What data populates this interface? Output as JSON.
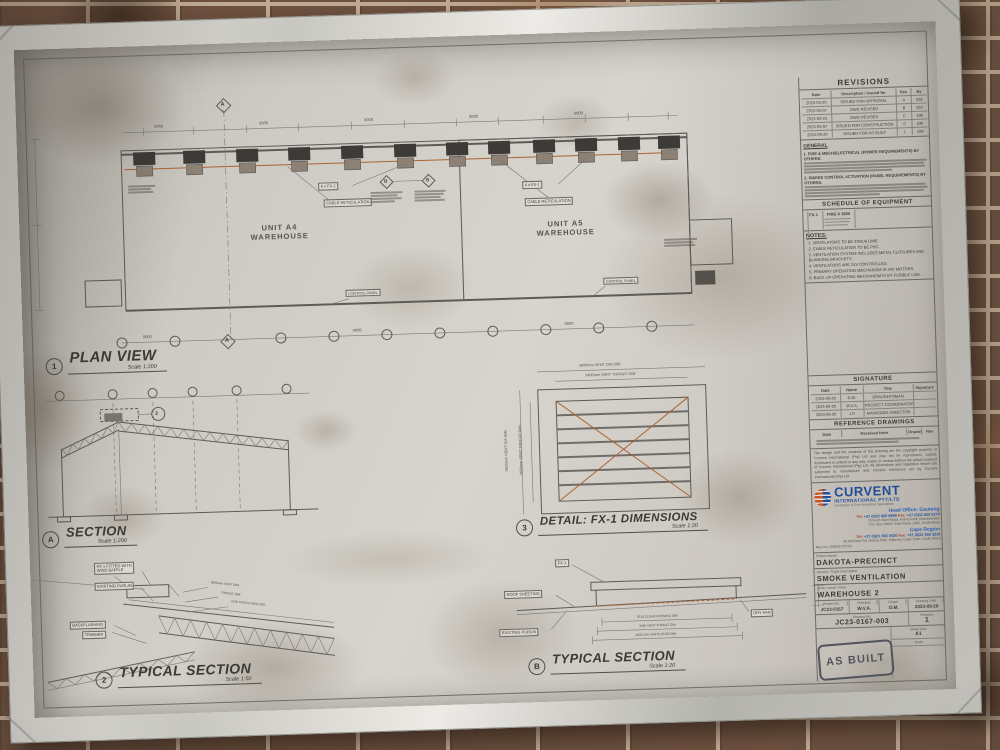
{
  "stamp": "AS BUILT",
  "plan": {
    "marker": "1",
    "title": "PLAN VIEW",
    "scale": "Scale 1:200",
    "unit_a4": "UNIT A4\nWAREHOUSE",
    "unit_a5": "UNIT A5\nWAREHOUSE",
    "fx_count_left": "6 x FX-1",
    "fx_count_right": "4 x FX-1",
    "cable_label": "CABLE RETICULATION",
    "control_label": "CONTROL PANEL",
    "bay_dim": "9000",
    "grid_a": "A",
    "grid_b": "B"
  },
  "section_a": {
    "marker": "A",
    "title": "SECTION",
    "scale": "Scale 1:200",
    "detail_ref": "2"
  },
  "detail_fx1": {
    "marker": "3",
    "title": "DETAIL: FX-1 DIMENSIONS",
    "scale": "Scale 1:20",
    "dim_oa_w": "3600mm VENT O/A DIM",
    "dim_throat_w": "3400mm VENT THROAT DIM",
    "dim_oa_h": "3600mm VENT O/A DIM",
    "dim_throat_h": "3400mm VENT THROAT DIM"
  },
  "typical_2": {
    "marker": "2",
    "title": "TYPICAL SECTION",
    "scale": "Scale 1:50",
    "label_baffle": "FX-1 FITTED WITH\nWIND BAFFLE",
    "label_purlin": "EXISTING PURLIN",
    "label_backflashing": "BACKFLASHING",
    "label_trimmer": "TRIMMER",
    "dim_1": "3600mm VENT DIM",
    "dim_2": "THROAT DIM",
    "dim_3": "END PURLIN SPACING"
  },
  "typical_b": {
    "marker": "B",
    "title": "TYPICAL SECTION",
    "scale": "Scale 1:20",
    "label_fx": "FX-1",
    "label_roof": "ROOF SHEETING",
    "label_purlin": "EXISTING PURLIN",
    "label_drypan": "DRY PAN",
    "dim_clear": "3518 CLEAR OPENING DIM",
    "dim_throat": "3400 VENT THROAT DIM",
    "dim_oa": "3600 O/A VENTILATOR DIM"
  },
  "titleblock": {
    "revisions": {
      "title": "REVISIONS",
      "col_date": "Date",
      "col_desc": "Description / Issued for",
      "col_rev": "Rev",
      "col_by": "By",
      "rows": [
        {
          "date": "2023-02-20",
          "desc": "ISSUED FOR APPROVAL",
          "rev": "A",
          "by": "DM"
        },
        {
          "date": "2023-03-07",
          "desc": "DWG REVISED",
          "rev": "B",
          "by": "DM"
        },
        {
          "date": "2023-03-23",
          "desc": "DWG REVISED",
          "rev": "C",
          "by": "DM"
        },
        {
          "date": "2023-05-07",
          "desc": "ISSUED FOR CONSTRUCTION",
          "rev": "0",
          "by": "DM"
        },
        {
          "date": "2023-09-20",
          "desc": "ISSUED FOR AS BUILT",
          "rev": "1",
          "by": "DM"
        }
      ]
    },
    "general": {
      "title": "GENERAL",
      "note1": "1. FIRE & MECH/ELECTRICAL (POWER REQUIREMENTS) BY OTHERS:",
      "note2": "2. SMOKE CONTROL ACTIVATION (PANEL REQUIREMENTS) BY OTHERS:"
    },
    "schedule": {
      "title": "SCHEDULE OF EQUIPMENT",
      "ref": "FX-1",
      "model": "FIRE-X 3600"
    },
    "notes": {
      "title": "NOTES:",
      "items": [
        "1. VENTILATORS TO BE ZINCALUME.",
        "2. CABLE RETICULATION TO BE PVC.",
        "3. VENTILATION SYSTEM INCLUDES METAL CLOSURES AND BLANKING BRACKETS.",
        "4. VENTILATORS ARE 24V CONTROLLED.",
        "5. PRIMARY OPERATING MECHANISM IS 24V MOTORS.",
        "6. BACK UP OPERATING MECHANISM IS BY FUSIBLE LINK."
      ]
    },
    "signature": {
      "title": "SIGNATURE",
      "col_date": "Date",
      "col_name": "Name",
      "col_title": "Title",
      "col_sign": "Signature",
      "rows": [
        {
          "date": "2023-09-20",
          "name": "D.M.",
          "title": "DRAUGHTSMAN",
          "sign": ""
        },
        {
          "date": "2023-09-20",
          "name": "W.V.A.",
          "title": "PROJECT COORDINATOR",
          "sign": ""
        },
        {
          "date": "2023-09-20",
          "name": "J.P.",
          "title": "MANAGING DIRECTOR",
          "sign": ""
        }
      ]
    },
    "reference": {
      "title": "REFERENCE DRAWINGS",
      "col_date": "Date",
      "col_from": "Received from",
      "col_no": "Drawing No.",
      "col_rev": "Rev"
    },
    "disclaimer": "The design and the contents of this drawing are the copyright property of Curvent International (Pty) Ltd and may not be reproduced, copied, distributed or utilised in any way, matter or means without the written consent of Curvent International (Pty) Ltd. All dimensions and capacities shown are subjected to manufacture and erection tolerances set by Curvent International (Pty) Ltd.",
    "company": {
      "name": "CURVENT",
      "subtitle": "INTERNATIONAL PTY/LTD",
      "tagline": "Ventilation & Fire Protection Specialists",
      "head_office": "Head Office: Gauteng",
      "head_tel_label": "Tel:",
      "head_tel": "+27 (0)11 826 8899",
      "head_fax_label": "Fax:",
      "head_fax": "+27 (0)11 826 5279",
      "head_addr1": "75 North Reef Road, Activia Park, Elandsfontein",
      "head_addr2": "P.O. Box 24653, East Rand, 1462, South Africa",
      "cape_office": "Cape Region",
      "cape_tel_label": "Tel:",
      "cape_tel": "+27 (0)21 556 0430",
      "cape_fax_label": "Fax:",
      "cape_fax": "+27 (0)21 556 3216",
      "cape_addr": "56 McClean Rd, Racing Park, Killarney, Cape Town, South Africa",
      "reg": "Reg. No. 2004/015707/07"
    },
    "project": {
      "name_label": "Project Name",
      "name": "DAKOTA-PRECINCT",
      "service_label": "Service / Trade Description",
      "service": "SMOKE VENTILATION",
      "zone_label": "Zone / Level / Area",
      "zone": "WAREHOUSE 2",
      "no_label": "Project No.",
      "no": "JC23-0167",
      "checked_label": "Checked",
      "checked": "W.V.A.",
      "drawn_label": "Drawn",
      "drawn": "D.M.",
      "date_label": "Drawing Date",
      "date": "2023-09-20",
      "dwg_label": "Drawing No.",
      "dwg": "JC23-0167-003",
      "rev_label": "Revision",
      "rev": "1",
      "sheet_label": "Sheet Size",
      "sheet": "A1",
      "scale_label": "Scale",
      "scale": ""
    }
  }
}
